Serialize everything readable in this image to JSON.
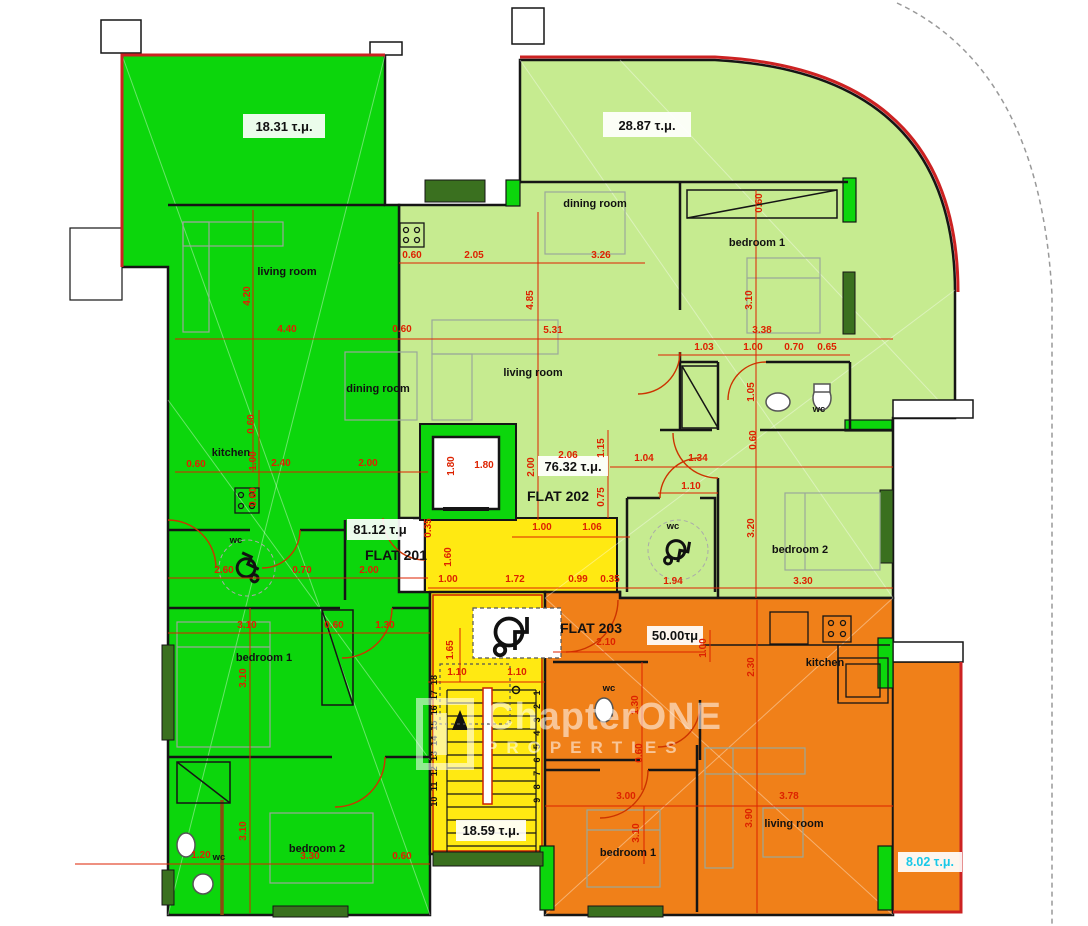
{
  "flats": {
    "f201": {
      "label": "FLAT 201",
      "area": "81.12 τ.μ",
      "veranda": "18.31 τ.μ.",
      "living": "living room",
      "dining": "dining room",
      "kitchen": "kitchen",
      "wc": "wc",
      "bedroom1": "bedroom 1",
      "bedroom2": "bedroom 2",
      "wc2": "wc"
    },
    "f202": {
      "label": "FLAT 202",
      "area": "76.32 τ.μ.",
      "veranda": "28.87 τ.μ.",
      "dining": "dining room",
      "living": "living room",
      "bedroom1": "bedroom 1",
      "wc": "wc",
      "wc2": "wc",
      "bedroom2": "bedroom 2"
    },
    "f203": {
      "label": "FLAT 203",
      "area": "50.00τμ",
      "balcony": "8.02 τ.μ.",
      "wc": "wc",
      "kitchen": "kitchen",
      "bedroom1": "bedroom 1",
      "living": "living room"
    },
    "stair": {
      "area": "18.59 τ.μ."
    }
  },
  "watermark": {
    "line1": "ChapterONE",
    "line2": "PROPERTIES"
  },
  "stairs": {
    "left": [
      "18",
      "17",
      "16",
      "15",
      "14",
      "13",
      "12",
      "11",
      "10"
    ],
    "right": [
      "1",
      "2",
      "3",
      "4",
      "5",
      "6",
      "7",
      "8",
      "9"
    ]
  },
  "colors": {
    "flat201": "#0cd60c",
    "flat202": "#c6eb90",
    "flat203": "#f08019",
    "stair": "#ffe912",
    "dimension": "#dd2200",
    "wall": "#151515",
    "balcony_label": "#19c8e8",
    "boundary_red": "#cc2222",
    "window_hatch": "#3a701f"
  },
  "dimensions": [
    {
      "t": "4.20",
      "x": 250,
      "y": 296,
      "r": 1
    },
    {
      "t": "4.40",
      "x": 287,
      "y": 332
    },
    {
      "t": "0.60",
      "x": 402,
      "y": 332
    },
    {
      "t": "0.60",
      "x": 412,
      "y": 258
    },
    {
      "t": "2.05",
      "x": 474,
      "y": 258
    },
    {
      "t": "3.26",
      "x": 601,
      "y": 258
    },
    {
      "t": "4.85",
      "x": 533,
      "y": 300,
      "r": 1
    },
    {
      "t": "5.31",
      "x": 553,
      "y": 333
    },
    {
      "t": "0.60",
      "x": 762,
      "y": 203,
      "r": 1
    },
    {
      "t": "3.10",
      "x": 752,
      "y": 300,
      "r": 1
    },
    {
      "t": "3.38",
      "x": 762,
      "y": 333
    },
    {
      "t": "1.03",
      "x": 704,
      "y": 350
    },
    {
      "t": "1.00",
      "x": 753,
      "y": 350
    },
    {
      "t": "0.70",
      "x": 794,
      "y": 350
    },
    {
      "t": "0.65",
      "x": 827,
      "y": 350
    },
    {
      "t": "1.05",
      "x": 754,
      "y": 392,
      "r": 1
    },
    {
      "t": "0.60",
      "x": 756,
      "y": 440,
      "r": 1
    },
    {
      "t": "1.04",
      "x": 644,
      "y": 461
    },
    {
      "t": "1.34",
      "x": 698,
      "y": 461
    },
    {
      "t": "2.06",
      "x": 568,
      "y": 458
    },
    {
      "t": "2.00",
      "x": 534,
      "y": 467,
      "r": 1
    },
    {
      "t": "1.15",
      "x": 604,
      "y": 448,
      "r": 1
    },
    {
      "t": "0.75",
      "x": 604,
      "y": 497,
      "r": 1
    },
    {
      "t": "1.10",
      "x": 691,
      "y": 489
    },
    {
      "t": "3.20",
      "x": 754,
      "y": 528,
      "r": 1
    },
    {
      "t": "3.30",
      "x": 803,
      "y": 584
    },
    {
      "t": "1.94",
      "x": 673,
      "y": 584
    },
    {
      "t": "0.60",
      "x": 254,
      "y": 424,
      "r": 1
    },
    {
      "t": "1.00",
      "x": 256,
      "y": 461,
      "r": 1
    },
    {
      "t": "2.40",
      "x": 281,
      "y": 466
    },
    {
      "t": "2.00",
      "x": 368,
      "y": 466
    },
    {
      "t": "0.60",
      "x": 196,
      "y": 467
    },
    {
      "t": "0.60",
      "x": 256,
      "y": 497,
      "r": 1
    },
    {
      "t": "2.60",
      "x": 224,
      "y": 573
    },
    {
      "t": "0.70",
      "x": 302,
      "y": 573
    },
    {
      "t": "2.00",
      "x": 369,
      "y": 573
    },
    {
      "t": "1.80",
      "x": 454,
      "y": 466,
      "r": 1
    },
    {
      "t": "1.80",
      "x": 484,
      "y": 468
    },
    {
      "t": "0.35",
      "x": 431,
      "y": 528,
      "r": 1
    },
    {
      "t": "1.60",
      "x": 451,
      "y": 557,
      "r": 1
    },
    {
      "t": "1.00",
      "x": 542,
      "y": 530
    },
    {
      "t": "1.06",
      "x": 592,
      "y": 530
    },
    {
      "t": "1.00",
      "x": 448,
      "y": 582
    },
    {
      "t": "1.72",
      "x": 515,
      "y": 582
    },
    {
      "t": "0.99",
      "x": 578,
      "y": 582
    },
    {
      "t": "0.35",
      "x": 610,
      "y": 582
    },
    {
      "t": "1.65",
      "x": 453,
      "y": 650,
      "r": 1
    },
    {
      "t": "1.10",
      "x": 457,
      "y": 675
    },
    {
      "t": "1.10",
      "x": 517,
      "y": 675
    },
    {
      "t": "3.10",
      "x": 247,
      "y": 628
    },
    {
      "t": "0.60",
      "x": 334,
      "y": 628
    },
    {
      "t": "1.30",
      "x": 385,
      "y": 628
    },
    {
      "t": "3.10",
      "x": 246,
      "y": 678,
      "r": 1
    },
    {
      "t": "3.10",
      "x": 246,
      "y": 831,
      "r": 1
    },
    {
      "t": "3.30",
      "x": 310,
      "y": 859
    },
    {
      "t": "0.60",
      "x": 402,
      "y": 859
    },
    {
      "t": "1.20",
      "x": 201,
      "y": 858
    },
    {
      "t": "2.10",
      "x": 606,
      "y": 645
    },
    {
      "t": "1.00",
      "x": 706,
      "y": 648,
      "r": 1
    },
    {
      "t": "1.30",
      "x": 638,
      "y": 705,
      "r": 1
    },
    {
      "t": "0.60",
      "x": 642,
      "y": 753,
      "r": 1
    },
    {
      "t": "3.00",
      "x": 626,
      "y": 799
    },
    {
      "t": "3.10",
      "x": 639,
      "y": 833,
      "r": 1
    },
    {
      "t": "3.78",
      "x": 789,
      "y": 799
    },
    {
      "t": "3.90",
      "x": 752,
      "y": 818,
      "r": 1
    },
    {
      "t": "2.30",
      "x": 754,
      "y": 667,
      "r": 1
    }
  ]
}
